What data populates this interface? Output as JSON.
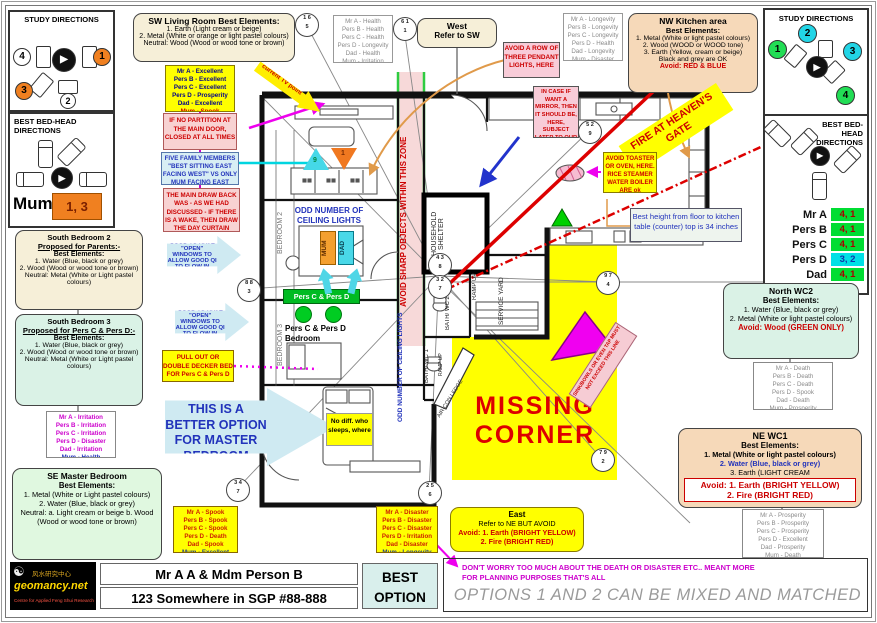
{
  "colors": {
    "yellow": "#ffff00",
    "pink_note": "#f8d2da",
    "mint": "#daf2e6",
    "cream": "#f6efd8",
    "peach": "#f6d9b9",
    "green": "#00cc00",
    "orange": "#f08020",
    "cyan": "#00dde6",
    "magenta": "#ee00ee",
    "red": "#cc0000",
    "blue": "#2222bb"
  },
  "icons": {
    "play": "▶",
    "yinyang": "☯"
  },
  "left_panel": {
    "study_title": "STUDY DIRECTIONS",
    "bedhead_title": "BEST BED-HEAD DIRECTIONS",
    "study_circles": [
      "4",
      "1",
      "3",
      "2"
    ],
    "mum_label": "Mum",
    "mum_value": "1, 3"
  },
  "right_panel": {
    "study_title": "STUDY DIRECTIONS",
    "bedhead_title": "BEST BED-HEAD DIRECTIONS",
    "study_circles": [
      "1",
      "2",
      "3",
      "4"
    ],
    "rows": [
      {
        "name": "Mr A",
        "value": "4, 1",
        "tone": "green"
      },
      {
        "name": "Pers B",
        "value": "4, 1",
        "tone": "green"
      },
      {
        "name": "Pers C",
        "value": "4, 1",
        "tone": "green"
      },
      {
        "name": "Pers D",
        "value": "3, 2",
        "tone": "cyan"
      },
      {
        "name": "Dad",
        "value": "4, 1",
        "tone": "green"
      }
    ]
  },
  "top": {
    "sw_living": {
      "title": "SW Living Room Best Elements:",
      "l1": "1. Earth (Light cream or beige)",
      "l2": "2. Metal (White or orange or light pastel colours)",
      "l3": "Neutral: Wood (Wood or wood tone or brown)"
    },
    "sw_list": [
      "Mr A -  Excellent",
      "Pers B -  Excellent",
      "Pers C -  Excellent",
      "Pers D -  Prosperity",
      "Dad -  Excellent",
      "Mum -  Spook"
    ],
    "west_list": [
      "Mr A -  Health",
      "Pers B -  Health",
      "Pers C -  Health",
      "Pers D -  Longevity",
      "Dad -  Health",
      "Mum -  Irritation"
    ],
    "west": {
      "title": "West",
      "sub": "Refer to SW"
    },
    "nw_list": [
      "Mr A -  Longevity",
      "Pers B -  Longevity",
      "Pers C -  Longevity",
      "Pers D -  Health",
      "Dad -  Longevity",
      "Mum -  Disaster"
    ],
    "nw_kitchen": {
      "title": "NW Kitchen area",
      "sub": "Best Elements:",
      "l1": "1. Metal (White or light pastel colours)",
      "l2": "2. Wood (WOOD or WOOD tone)",
      "l3": "3. Earth (Yellow, cream or beige)",
      "l4": "Black and grey are OK",
      "avoid": "Avoid: RED & BLUE"
    },
    "avoid_pendant": "AVOID A ROW OF THREE PENDANT LIGHTS, HERE",
    "mirror": "IN CASE IF WANT A MIRROR, THEN IT SHOULD BE, HERE, SUBJECT LATER TO OUR DISCUSSION",
    "fire_gate": "FIRE AT HEAVEN'S GATE",
    "current_tv": "current TV point"
  },
  "left_col": {
    "bed2": {
      "title": "South Bedroom 2",
      "proposed": "Proposed for Parents:-",
      "sub": "Best Elements:",
      "l1": "1. Water (Blue, black or grey)",
      "l2": "2. Wood (Wood or wood tone or brown)",
      "l3": "Neutral: Metal (White or Light pastel colours)"
    },
    "bed3": {
      "title": "South Bedroom 3",
      "proposed": "Proposed for Pers C & Pers D:-",
      "sub": "Best Elements:",
      "l1": "1. Water (Blue, black or grey)",
      "l2": "2. Wood (Wood or wood tone or brown)",
      "l3": "Neutral: Metal (White or Light pastel colours)"
    },
    "south3_list": [
      "Mr A -  Irritation",
      "Pers B -  Irritation",
      "Pers C -  Irritation",
      "Pers D -  Disaster",
      "Dad -  Irritation",
      "Mum -  Health"
    ],
    "se_master": {
      "title": "SE Master Bedroom",
      "sub": "Best Elements:",
      "l1": "1. Metal (White or Light pastel colours)",
      "l2": "2. Water (Blue, black or grey)",
      "l3": "Neutral: a. Light cream or beige b. Wood (Wood or wood tone or brown)"
    },
    "no_partition": "IF NO PARTITION AT THE MAIN DOOR, CLOSED AT ALL TIMES",
    "five_family": "FIVE FAMILY MEMBERS \"BEST SITTING EAST FACING WEST\" VS ONLY MUM FACING EAST",
    "drawback": "THE MAIN DRAW BACK WAS - AS WE HAD DISCUSSED - IF THERE IS A WAKE, THEN DRAW THE DAY CURTAIN",
    "open_windows": "GOOD TO HAVE \"OPEN\" WINDOWS TO ALLOW GOOD QI TO FLOW IN",
    "pull_out": "PULL OUT OR DOUBLE DECKER BED FOR Pers C & Pers D",
    "better_option": "THIS IS A BETTER OPTION FOR MASTER BEDROOM"
  },
  "plan": {
    "bedroom2": "BEDROOM 2",
    "bedroom3": "BEDROOM 3",
    "odd_lights": "ODD NUMBER OF CEILING LIGHTS",
    "mum": "MUM",
    "dad": "DAD",
    "pers_cd": "Pers C & Pers D",
    "pers_cd_bedroom": "Pers C & Pers D Bedroom",
    "household": "HOUSEHOLD SHELTER",
    "ramp": "RAMP UP",
    "service": "SERVICE YARD",
    "bath2": "BATH/ WC 2",
    "bath1": "BATH/ WC 1",
    "aircon": "AIR-CON LEDGE",
    "missing1": "MISSING",
    "missing2": "CORNER",
    "no_diff": "No diff. who sleeps, where",
    "avoid_sharp": "AVOID SHARP OBJECTS WITHIN THIS ZONE",
    "sink_line": "SINK/BOWLS OR EVEN TAP MUST NOT EXCEED THIS LINE",
    "tri_cyan": "9",
    "tri_orange": "1",
    "star_circles": [
      {
        "top": "1 6",
        "bottom": "5",
        "x": 306,
        "y": 24
      },
      {
        "top": "6 1",
        "bottom": "1",
        "x": 404,
        "y": 28
      },
      {
        "top": "5 2",
        "bottom": "9",
        "x": 589,
        "y": 131
      },
      {
        "top": "8 8",
        "bottom": "3",
        "x": 248,
        "y": 289
      },
      {
        "top": "4 3",
        "bottom": "8",
        "x": 439,
        "y": 264
      },
      {
        "top": "3 2",
        "bottom": "7",
        "x": 439,
        "y": 286
      },
      {
        "top": "9 7",
        "bottom": "4",
        "x": 607,
        "y": 282
      },
      {
        "top": "7 9",
        "bottom": "2",
        "x": 602,
        "y": 459
      },
      {
        "top": "3 4",
        "bottom": "7",
        "x": 237,
        "y": 489
      },
      {
        "top": "2 5",
        "bottom": "6",
        "x": 429,
        "y": 492
      }
    ]
  },
  "right_col": {
    "toaster": "AVOID TOASTER OR OVEN, HERE. RICE STEAMER WATER BOILER ARE ok",
    "counter_height": "Best height from floor to kitchen table (counter) top is 34 inches",
    "north_wc2": {
      "title": "North WC2",
      "sub": "Best Elements:",
      "l1": "1. Water (Blue, black or grey)",
      "l2": "2. Metal (White or light pastel colours)",
      "avoid": "Avoid: Wood (GREEN ONLY)"
    },
    "north_list": [
      "Mr A -  Death",
      "Pers B -  Death",
      "Pers C -  Death",
      "Pers D -  Spook",
      "Dad -  Death",
      "Mum -  Prosperity"
    ],
    "ne_wc1": {
      "title": "NE  WC1",
      "sub": "Best Elements:",
      "l1": "1. Metal (White or light pastel colours)",
      "l2": "2. Water (Blue, black or grey)",
      "l3": "3. Earth (LIGHT CREAM",
      "avoid1": "Avoid: 1. Earth (BRIGHT YELLOW)",
      "avoid2": "2. Fire (BRIGHT RED)"
    },
    "ne_list": [
      "Mr A -  Prosperity",
      "Pers B -  Prosperity",
      "Pers C -  Prosperity",
      "Pers D -  Excellent",
      "Dad -  Prosperity",
      "Mum -  Death"
    ]
  },
  "bottom": {
    "sw2_list": [
      "Mr A -  Spook",
      "Pers B -  Spook",
      "Pers C -  Spook",
      "Pers D -  Death",
      "Dad -  Spook",
      "Mum -  Excellent"
    ],
    "east_list": [
      "Mr A -  Disaster",
      "Pers B -  Disaster",
      "Pers C -  Disaster",
      "Pers D -  Irritation",
      "Dad -  Disaster",
      "Mum -  Longevity"
    ],
    "east": {
      "title": "East",
      "l1": "Refer to NE BUT AVOID",
      "avoid1": "Avoid: 1. Earth (BRIGHT YELLOW)",
      "avoid2": "2. Fire (BRIGHT RED)"
    },
    "dont_worry": "DON'T WORRY TOO MUCH ABOUT THE DEATH OR DISASTER ETC.. MEANT MORE FOR PLANNING PURPOSES THAT'S ALL",
    "options_note": "OPTIONS 1 AND 2 CAN BE MIXED AND MATCHED"
  },
  "footer": {
    "logo_name": "geomancy.net",
    "logo_cn": "风水研究中心",
    "logo_sub": "Centre for Applied Feng Shui Research",
    "name": "Mr A A & Mdm Person B",
    "address": "123 Somewhere in SGP #88-888",
    "best_option_1": "BEST",
    "best_option_2": "OPTION"
  }
}
